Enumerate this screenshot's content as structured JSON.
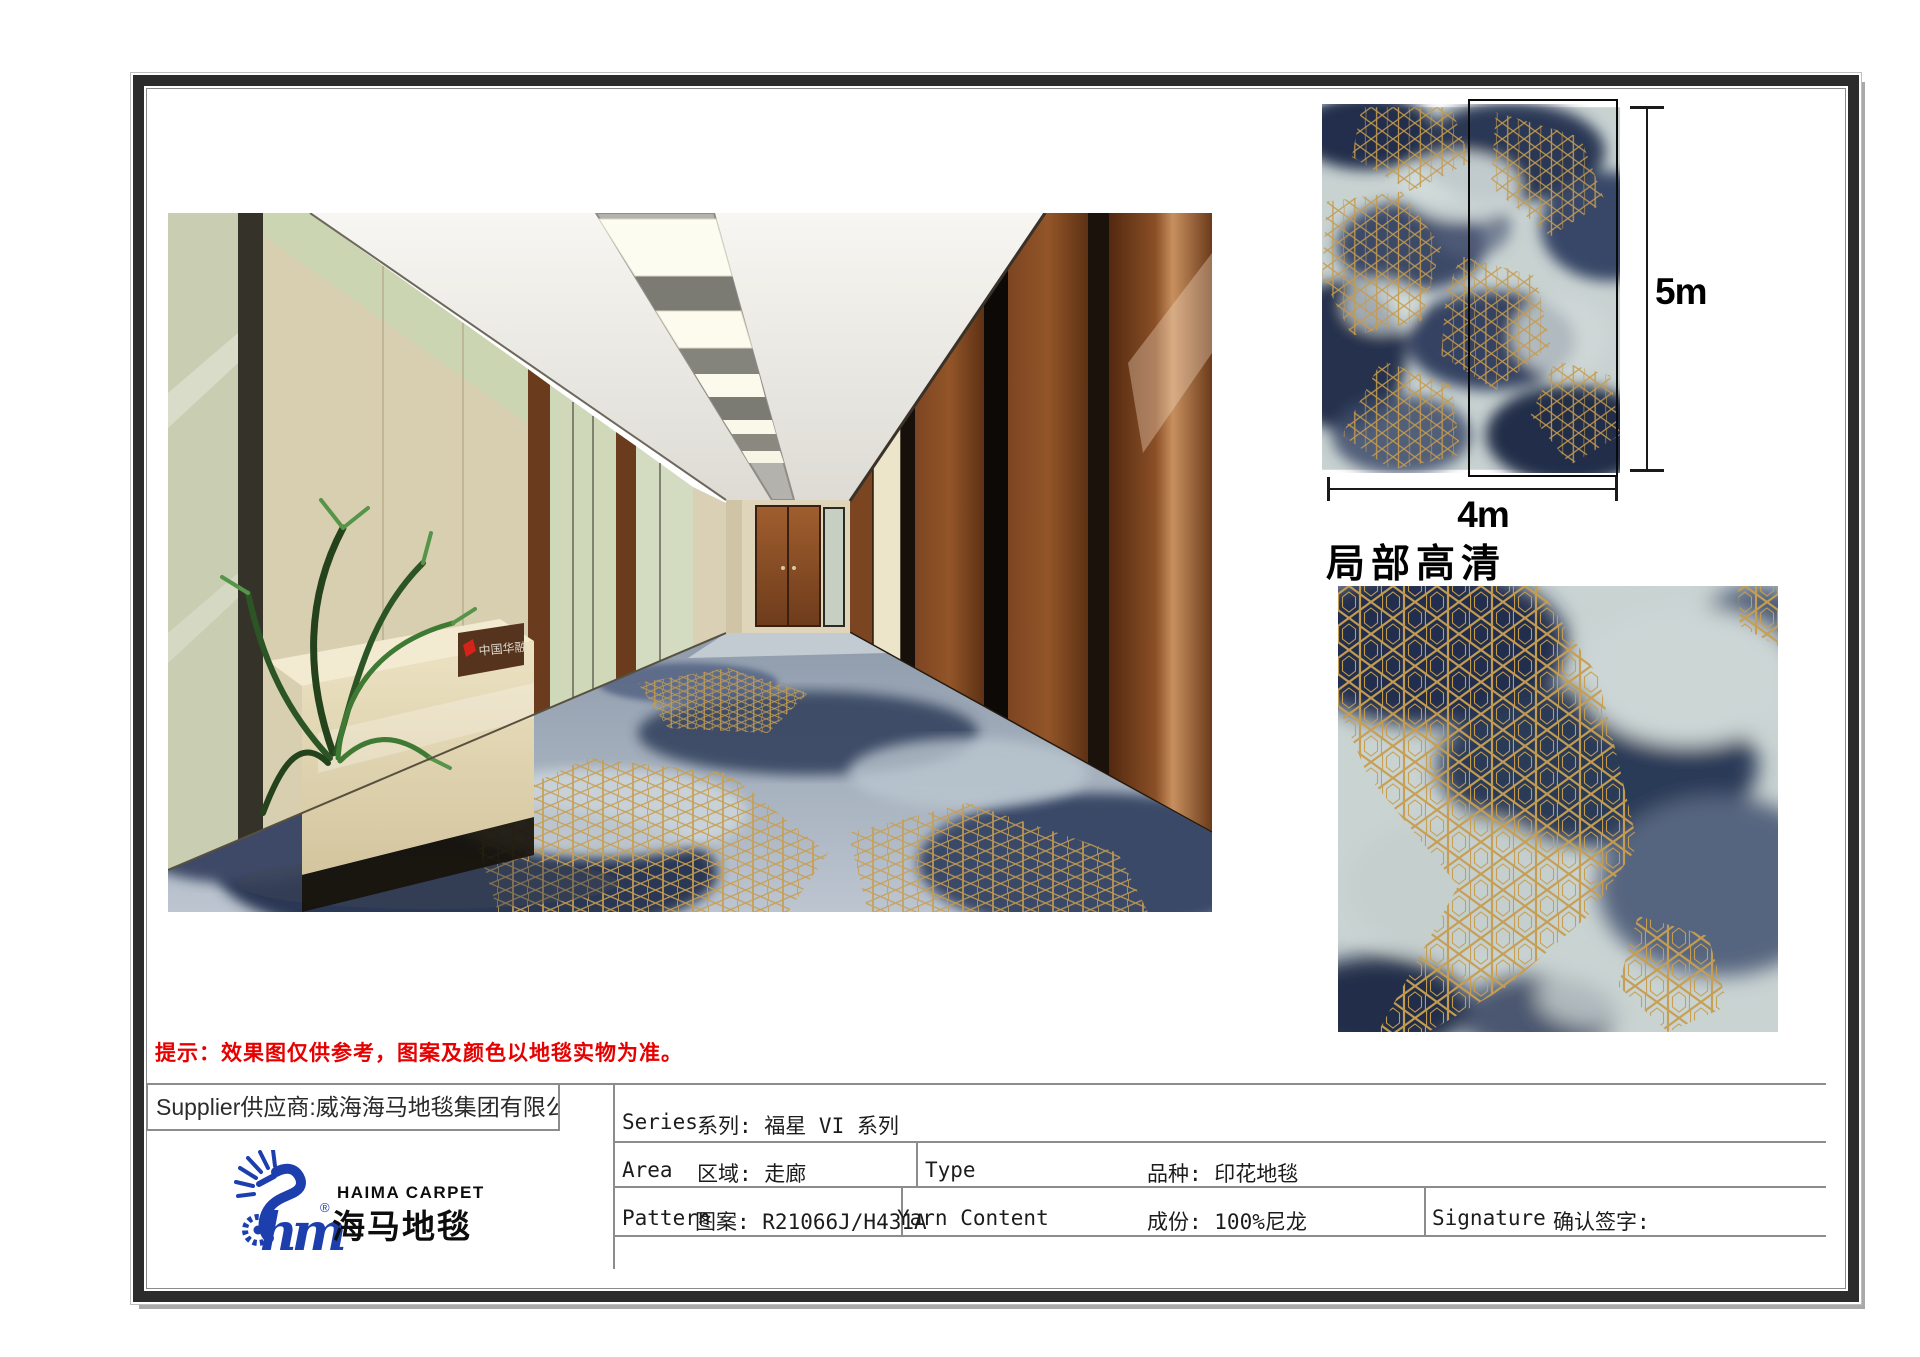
{
  "swatch": {
    "height_label": "5m",
    "width_label": "4m"
  },
  "detail": {
    "heading": "局部高清"
  },
  "note": {
    "text": "提示：效果图仅供参考，图案及颜色以地毯实物为准。"
  },
  "supplier": {
    "text": "Supplier供应商:威海海马地毯集团有限公司"
  },
  "brand": {
    "name_en": "HAIMA CARPET",
    "name_cn": "海马地毯",
    "script": "hm",
    "registered": "®"
  },
  "spec": {
    "series_label": "Series",
    "series_value": "系列: 福星 VI 系列",
    "area_label": "Area",
    "area_value": "区域: 走廊",
    "type_label": "Type",
    "type_value": "品种: 印花地毯",
    "pattern_label": "Pattern",
    "pattern_value": "图案: R21066J/H431A",
    "yarn_label": "Yarn Content",
    "yarn_value": "成份: 100%尼龙",
    "signature_label": "Signature",
    "signature_value": "确认签字:"
  },
  "render": {
    "wall_logo": "中国华融"
  },
  "colors": {
    "gold": "#c79e50",
    "navy": "#26314e",
    "carpet_light": "#c8d2d1",
    "note_red": "#e60000",
    "brand_blue": "#1d3fae",
    "wood": "#8a4f26",
    "frame": "#2c2c2c",
    "table_line": "#8c8c8c"
  }
}
